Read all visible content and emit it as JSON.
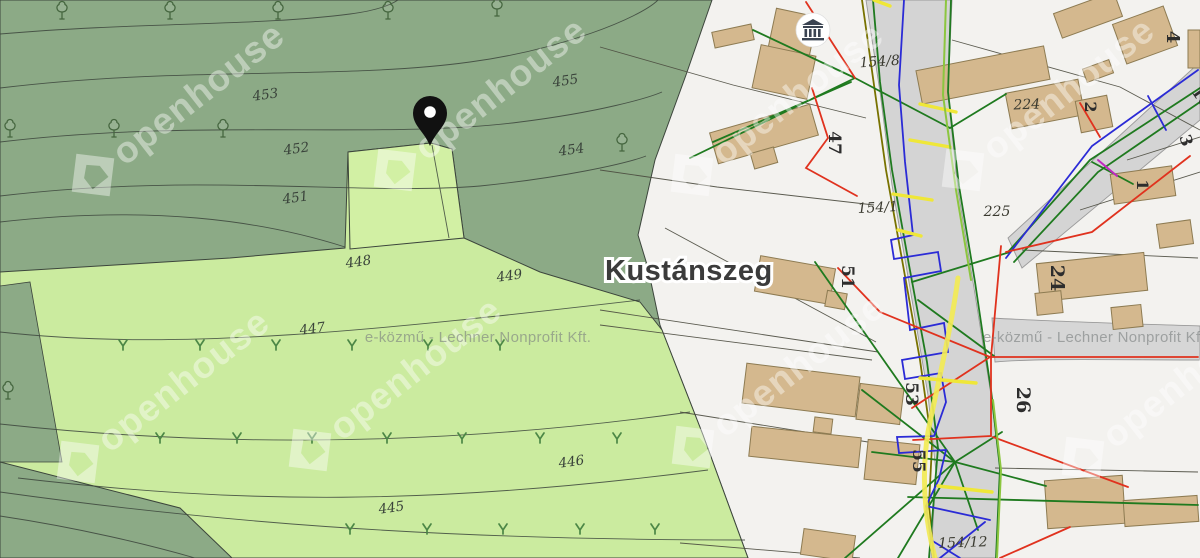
{
  "town": {
    "name": "Kustánszeg"
  },
  "attribution": {
    "brand_watermark": "openhouse",
    "utility_watermark": "e-közmű - Lechner Nonprofit Kft."
  },
  "map_symbols": {
    "pin": "location-pin",
    "museum": "museum-building-icon",
    "tree": "deciduous-tree-symbol",
    "grass": "grass-tuft-symbol"
  },
  "parcel_labels": [
    {
      "text": "453",
      "x": 266,
      "y": 99,
      "rot": -8
    },
    {
      "text": "452",
      "x": 297,
      "y": 153,
      "rot": -8
    },
    {
      "text": "451",
      "x": 296,
      "y": 202,
      "rot": -8
    },
    {
      "text": "455",
      "x": 566,
      "y": 85,
      "rot": -8
    },
    {
      "text": "454",
      "x": 572,
      "y": 154,
      "rot": -8
    },
    {
      "text": "448",
      "x": 359,
      "y": 266,
      "rot": -8
    },
    {
      "text": "449",
      "x": 510,
      "y": 280,
      "rot": -8
    },
    {
      "text": "447",
      "x": 313,
      "y": 333,
      "rot": -8
    },
    {
      "text": "446",
      "x": 572,
      "y": 466,
      "rot": -8
    },
    {
      "text": "445",
      "x": 392,
      "y": 512,
      "rot": -8
    }
  ],
  "lot_labels": [
    {
      "text": "154/8",
      "x": 880,
      "y": 66,
      "rot": -4
    },
    {
      "text": "224",
      "x": 1027,
      "y": 109,
      "rot": -2
    },
    {
      "text": "154/1",
      "x": 878,
      "y": 212,
      "rot": -3
    },
    {
      "text": "225",
      "x": 997,
      "y": 216,
      "rot": 0
    },
    {
      "text": "154/12",
      "x": 963,
      "y": 547,
      "rot": -2
    }
  ],
  "house_numbers": [
    {
      "text": "47",
      "x": 829,
      "y": 143,
      "rot": 90,
      "size": 17
    },
    {
      "text": "51",
      "x": 842,
      "y": 277,
      "rot": 90,
      "size": 17
    },
    {
      "text": "53",
      "x": 906,
      "y": 394,
      "rot": 90,
      "size": 17
    },
    {
      "text": "55",
      "x": 913,
      "y": 461,
      "rot": 90,
      "size": 17
    },
    {
      "text": "24",
      "x": 1051,
      "y": 278,
      "rot": 90,
      "size": 19
    },
    {
      "text": "26",
      "x": 1017,
      "y": 400,
      "rot": 90,
      "size": 19
    },
    {
      "text": "2",
      "x": 1085,
      "y": 107,
      "rot": 90,
      "size": 16
    },
    {
      "text": "4",
      "x": 1167,
      "y": 37,
      "rot": 90,
      "size": 18
    },
    {
      "text": "3",
      "x": 1181,
      "y": 142,
      "rot": 72,
      "size": 16
    },
    {
      "text": "1",
      "x": 1137,
      "y": 185,
      "rot": 90,
      "size": 16
    },
    {
      "text": "16",
      "x": 1197,
      "y": 100,
      "rot": 55,
      "size": 15
    }
  ],
  "colors": {
    "forest_green": "#8caa86",
    "field_green": "#cbeb9f",
    "highlight_parcel_green": "#d2f0a4",
    "background_white": "#f3f2ef",
    "road_gray": "#d4d4d4",
    "building_tan": "#d4b88e",
    "utility_red": "#e0321e",
    "utility_green": "#1f7a1f",
    "utility_blue": "#2b2bd6",
    "utility_yellow": "#f2ea55",
    "utility_olive": "#787200",
    "utility_magenta": "#c028c0",
    "pin_black": "#111111"
  }
}
